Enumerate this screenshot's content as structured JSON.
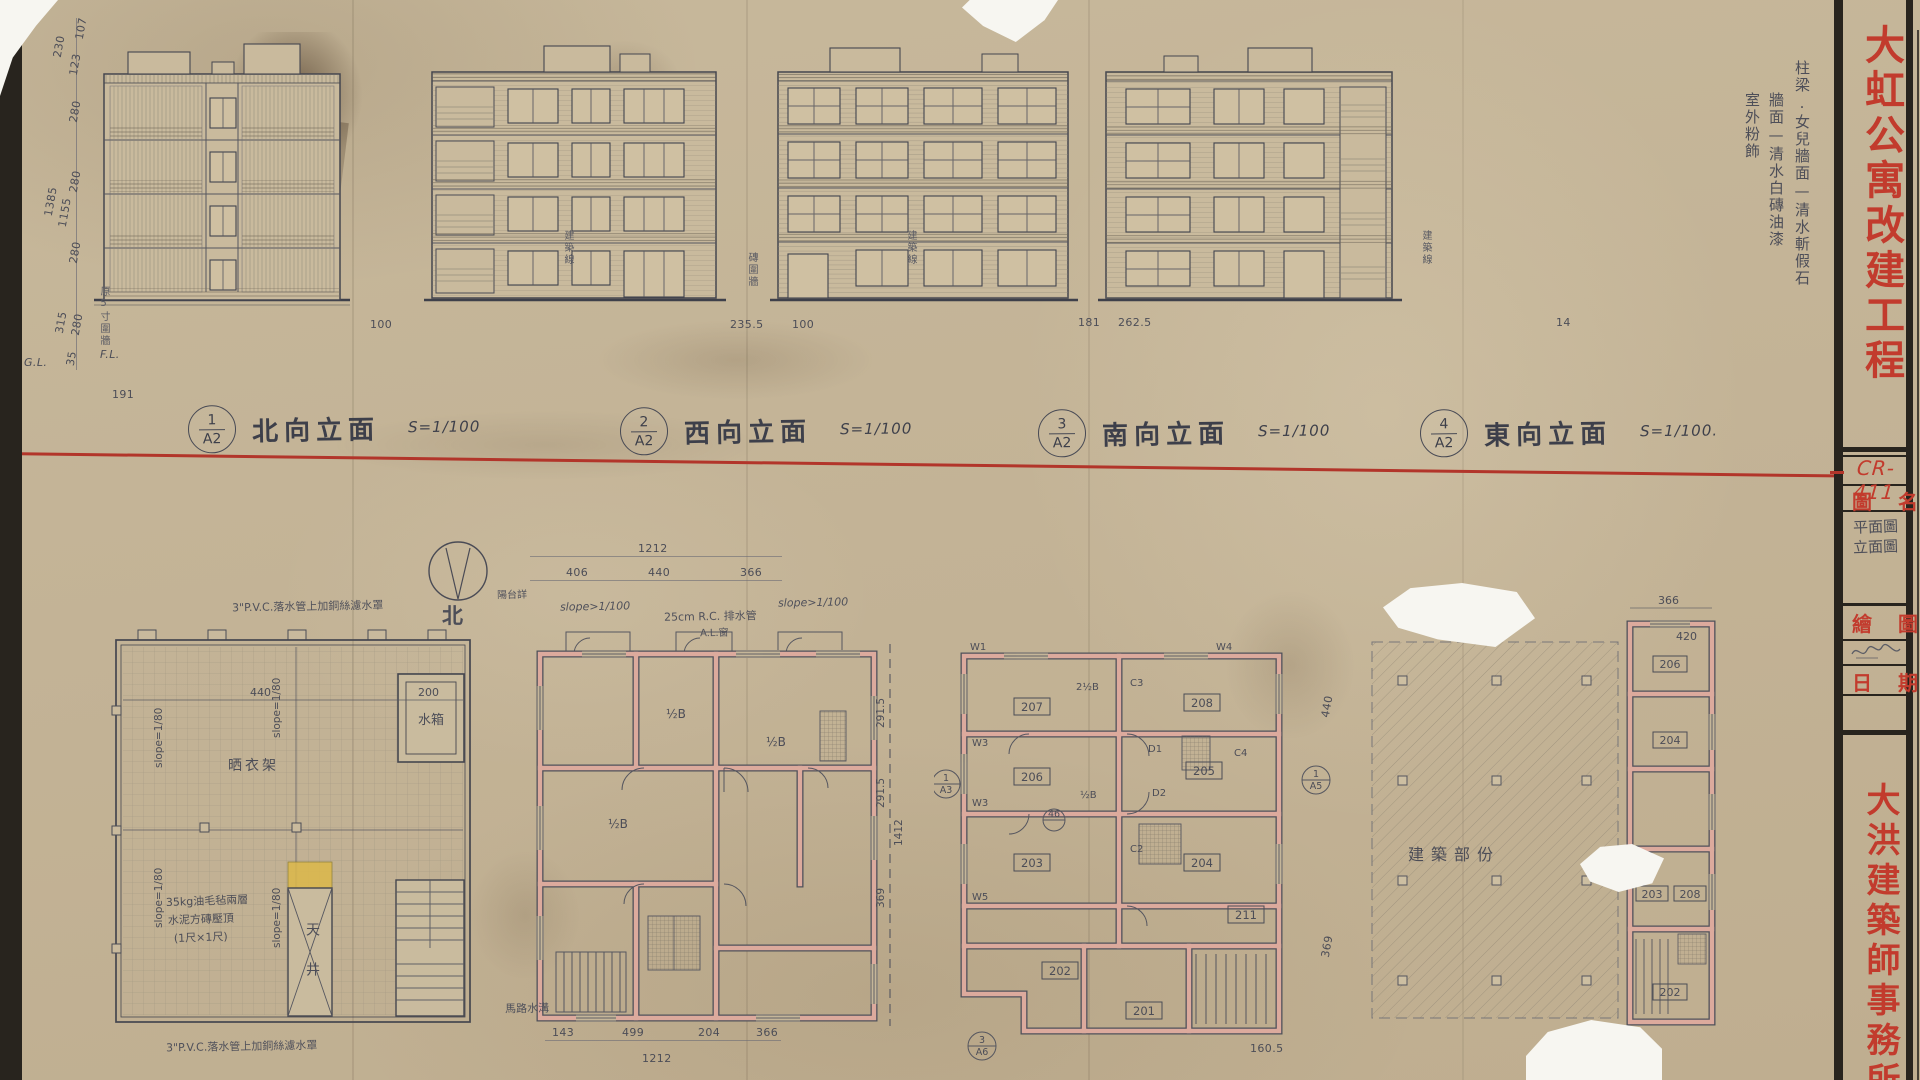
{
  "titleblock": {
    "project_title": "大虹公寓改建工程",
    "drawing_no": "CR-411",
    "drawing_name_label": "圖名",
    "drawing_name_value_1": "平面圖",
    "drawing_name_value_2": "立面圖",
    "drawn_by_label": "繪圖",
    "date_label": "日期",
    "firm_name": "大洪建築師事務所"
  },
  "finish_notes": {
    "col1": "柱梁.女兒牆面—清水斬假石",
    "col2": "牆面—清水白磚油漆",
    "col3": "室外粉飾"
  },
  "elevations": [
    {
      "ref_no": "1",
      "sheet": "A2",
      "title": "北向立面",
      "scale": "S=1/100"
    },
    {
      "ref_no": "2",
      "sheet": "A2",
      "title": "西向立面",
      "scale": "S=1/100"
    },
    {
      "ref_no": "3",
      "sheet": "A2",
      "title": "南向立面",
      "scale": "S=1/100"
    },
    {
      "ref_no": "4",
      "sheet": "A2",
      "title": "東向立面",
      "scale": "S=1/100."
    }
  ],
  "dims": {
    "left_stack": {
      "d1": "230",
      "d2": "123",
      "d3": "107",
      "d4": "280",
      "d5": "280",
      "d6": "1385",
      "d7": "1155",
      "d8": "280",
      "d9": "315",
      "d10": "280",
      "d11": "35",
      "gl": "G.L.",
      "fl": "F.L."
    },
    "ground": {
      "g1": "191",
      "g2": "100",
      "g3": "235.5",
      "g4": "100",
      "g5": "181",
      "g6": "262.5",
      "g7": "14"
    },
    "site_notes": {
      "n1": "原5寸圍牆",
      "n2": "建築線",
      "n3": "建築線",
      "n4": "建築線",
      "n5": "磚圍牆"
    }
  },
  "roof_plan": {
    "note_top": "3\"P.V.C.落水管上加銅絲濾水罩",
    "note_bottom": "3\"P.V.C.落水管上加銅絲濾水罩",
    "slope": "slope=1/80",
    "drying_rack": "晒衣架",
    "water_tank": "水箱",
    "light_well": "天井",
    "cap_note_1": "35kg油毛毡兩層",
    "cap_note_2": "水泥方磚壓頂",
    "cap_note_3": "(1尺×1尺)",
    "dim_a": "440",
    "dim_b": "200"
  },
  "compass": {
    "north": "北"
  },
  "typical_plan": {
    "stair_note": "陽台詳",
    "slope_note": "slope>1/100",
    "slope_note2": "slope>1/100",
    "drain_note": "25cm R.C. 排水管",
    "window_note": "A.L.窗",
    "road_note": "馬路水溝",
    "unit_label": "½B",
    "dim_top_total": "1212",
    "dim_top_1": "406",
    "dim_top_2": "440",
    "dim_top_3": "366",
    "dim_bot_1": "143",
    "dim_bot_2": "499",
    "dim_bot_3": "204",
    "dim_bot_4": "366",
    "dim_bot_total": "1212",
    "dim_r1": "291.5",
    "dim_r2": "291.5",
    "dim_r3": "369",
    "dim_r_total": "1412",
    "dim_far_r1": "440",
    "dim_far_r2": "369"
  },
  "unit_plan": {
    "rooms": {
      "r207": "207",
      "r208": "208",
      "r206": "206",
      "r205": "205",
      "r203": "203",
      "r204": "204",
      "r211": "211",
      "r202": "202",
      "r201": "201"
    },
    "marks": {
      "w1": "W1",
      "w3a": "W3",
      "w3b": "W3",
      "w4": "W4",
      "w5": "W5",
      "c2": "C2",
      "c3": "C3",
      "c4": "C4",
      "d1": "D1",
      "d2": "D2"
    },
    "labels": {
      "l1": "2½B",
      "l2": "½B"
    },
    "refs": {
      "ref1_no": "1",
      "ref1_sheet": "A3",
      "ref2_no": "3",
      "ref2_sheet": "A6",
      "ref3_no": "1",
      "ref3_sheet": "A5"
    },
    "col_bubble": "46",
    "dim_bottom": "160.5"
  },
  "partial_plan": {
    "hatch_label": "建築部份",
    "rooms": {
      "r206": "206",
      "r204": "204",
      "r203": "203",
      "r208": "208",
      "r202": "202"
    },
    "dim_1": "366",
    "dim_2": "420"
  }
}
